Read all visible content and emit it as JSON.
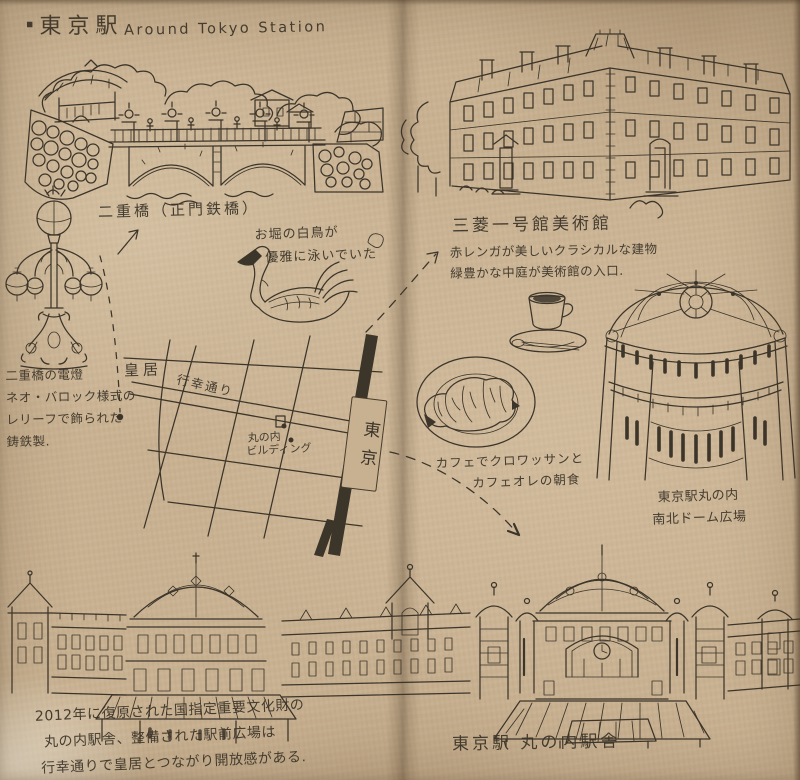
{
  "colors": {
    "paper": "#c8b191",
    "ink": "#3c352a",
    "gutter_shadow": "#5a3f26"
  },
  "header": {
    "bullet": "▪",
    "title_jp": "東京駅",
    "title_en": "Around Tokyo Station"
  },
  "bridge": {
    "caption": "二重橋（正門鉄橋）"
  },
  "swan": {
    "note_line1": "お堀の白鳥が",
    "note_line2": "優雅に泳いでいた"
  },
  "lamp": {
    "note_line1": "二重橋の電燈",
    "note_line2": "ネオ・バロック様式の",
    "note_line3": "レリーフで飾られた",
    "note_line4": "鋳鉄製."
  },
  "map": {
    "imperial_palace": "皇居",
    "gyoko_street": "行幸通り",
    "marunouchi_line1": "丸の内",
    "marunouchi_line2": "ビルディング",
    "station_sign": "東京"
  },
  "museum": {
    "title": "三菱一号館美術館",
    "note_line1": "赤レンガが美しいクラシカルな建物",
    "note_line2": "緑豊かな中庭が美術館の入口."
  },
  "cafe": {
    "note_line1": "カフェでクロワッサンと",
    "note_line2": "カフェオレの朝食"
  },
  "dome": {
    "label_line1": "東京駅丸の内",
    "label_line2": "南北ドーム広場"
  },
  "station": {
    "caption": "東京駅 丸の内駅舎",
    "note_line1": "2012年に復原された国指定重要文化財の",
    "note_line2": "丸の内駅舎、整備された駅前広場は",
    "note_line3": "行幸通りで皇居とつながり開放感がある."
  }
}
